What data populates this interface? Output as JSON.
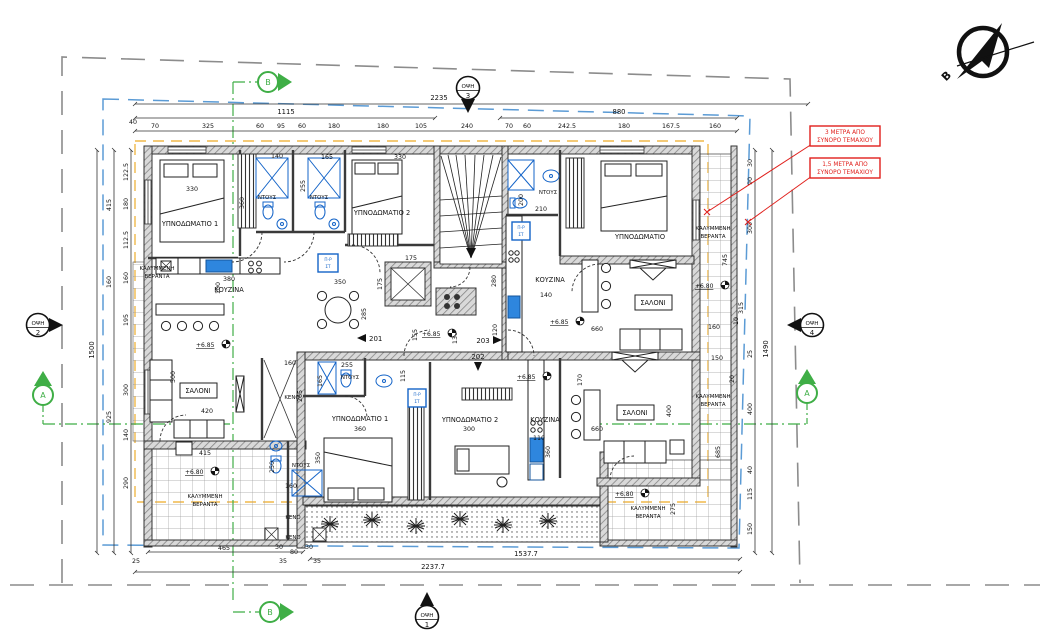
{
  "drawing": {
    "north_label": "Β",
    "red_notes": [
      {
        "l1": "3 ΜΕΤΡΑ ΑΠΟ",
        "l2": "ΣΥΝΟΡΟ ΤΕΜΑΧΙΟΥ"
      },
      {
        "l1": "1,5 ΜΕΤΡΑ ΑΠΟ",
        "l2": "ΣΥΝΟΡΟ ΤΕΜΑΧΙΟΥ"
      }
    ],
    "view_markers": [
      {
        "label": "ΟΨΗ",
        "num": "1"
      },
      {
        "label": "ΟΨΗ",
        "num": "2"
      },
      {
        "label": "ΟΨΗ",
        "num": "3"
      },
      {
        "label": "ΟΨΗ",
        "num": "4"
      }
    ],
    "sections": {
      "a": "A",
      "b": "B"
    },
    "units": {
      "u201": "201",
      "u202": "202",
      "u203": "203"
    },
    "levels": {
      "p685": "+6.85",
      "p680": "+6.80"
    },
    "rooms": {
      "bedroom1": "ΥΠΝΟΔΩΜΑΤΙΟ 1",
      "bedroom2": "ΥΠΝΟΔΩΜΑΤΙΟ 2",
      "bedroom": "ΥΠΝΟΔΩΜΑΤΙΟ",
      "kitchen": "ΚΟΥΖΙΝΑ",
      "living": "ΣΑΛΟΝΙ",
      "shower": "ΝΤΟΥΣ",
      "void": "ΚΕΝΟ",
      "covered1": "ΚΑΛΥΜΜΕΝΗ",
      "covered2": "ΒΕΡΑΝΤΑ",
      "washer": "Π-Ρ",
      "dryer": "ΣΤ"
    },
    "dims": {
      "overall_top": "2235",
      "span_left": "1115",
      "span_right": "880",
      "top_row": [
        "40",
        "70",
        "325",
        "60",
        "95",
        "60",
        "180",
        "180",
        "105",
        "240",
        "70",
        "60",
        "242.5",
        "180",
        "167.5",
        "160"
      ],
      "overall_left": "1500",
      "left_outer": [
        "415",
        "160",
        "925"
      ],
      "left_inner": [
        "122.5",
        "180",
        "112.5",
        "160",
        "195",
        "300",
        "140",
        "290"
      ],
      "overall_right": "1490",
      "right_outer": [
        "30",
        "90",
        "300",
        "25",
        "400",
        "40",
        "115",
        "150"
      ],
      "right_inner": [
        "745",
        "315",
        "10",
        "20",
        "685",
        "275"
      ],
      "bottom_row": [
        "25",
        "465",
        "30",
        "80",
        "30",
        "35",
        "35"
      ],
      "bottom_span": "1537.7",
      "overall_bottom": "2237.7",
      "interior": [
        "330",
        "360",
        "140",
        "165",
        "255",
        "330",
        "380",
        "100",
        "350",
        "175",
        "175",
        "285",
        "155",
        "130",
        "115",
        "255",
        "160",
        "165",
        "265",
        "350",
        "360",
        "250",
        "160",
        "300",
        "110",
        "360",
        "660",
        "170",
        "660",
        "400",
        "420",
        "500",
        "415",
        "140",
        "280",
        "200",
        "210",
        "120",
        "160",
        "150"
      ]
    }
  }
}
